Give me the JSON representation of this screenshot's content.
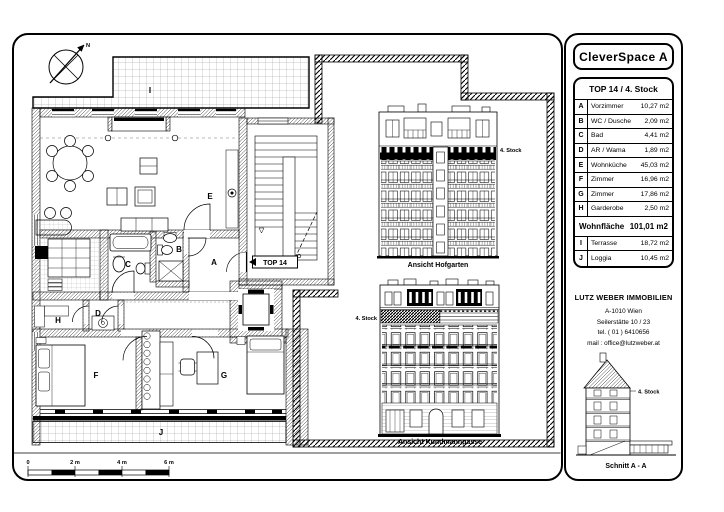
{
  "colors": {
    "ink": "#000000",
    "paper": "#ffffff"
  },
  "title": "CleverSpace A",
  "unit": {
    "header": "TOP 14 / 4. Stock",
    "entrance_label": "TOP 14"
  },
  "rooms": [
    {
      "key": "A",
      "name": "Vorzimmer",
      "area": "10,27 m2"
    },
    {
      "key": "B",
      "name": "WC / Dusche",
      "area": "2,09 m2"
    },
    {
      "key": "C",
      "name": "Bad",
      "area": "4,41 m2"
    },
    {
      "key": "D",
      "name": "AR / Wama",
      "area": "1,89 m2"
    },
    {
      "key": "E",
      "name": "Wohnküche",
      "area": "45,03 m2"
    },
    {
      "key": "F",
      "name": "Zimmer",
      "area": "16,96 m2"
    },
    {
      "key": "G",
      "name": "Zimmer",
      "area": "17,86 m2"
    },
    {
      "key": "H",
      "name": "Garderobe",
      "area": "2,50 m2"
    }
  ],
  "total": {
    "label": "Wohnfläche",
    "area": "101,01 m2"
  },
  "outdoor": [
    {
      "key": "I",
      "name": "Terrasse",
      "area": "18,72 m2"
    },
    {
      "key": "J",
      "name": "Loggia",
      "area": "10,45 m2"
    }
  ],
  "contact": {
    "company": "LUTZ WEBER IMMOBILIEN",
    "address": "A-1010 Wien",
    "street": "Seilerstätte 10 / 23",
    "tel": "tel. ( 01 ) 6410656",
    "mail": "mail : office@lutzweber.at"
  },
  "elevations": {
    "hofgarten": {
      "caption": "Ansicht Hofgarten",
      "floor_label": "4. Stock"
    },
    "kundmanngasse": {
      "caption": "Ansicht Kundmanngasse",
      "floor_label": "4. Stock"
    }
  },
  "section": {
    "caption": "Schnitt A - A",
    "floor_label": "4. Stock"
  },
  "plan": {
    "north_label": "N",
    "scale_labels": [
      "0",
      "2 m",
      "4 m",
      "6 m"
    ]
  }
}
